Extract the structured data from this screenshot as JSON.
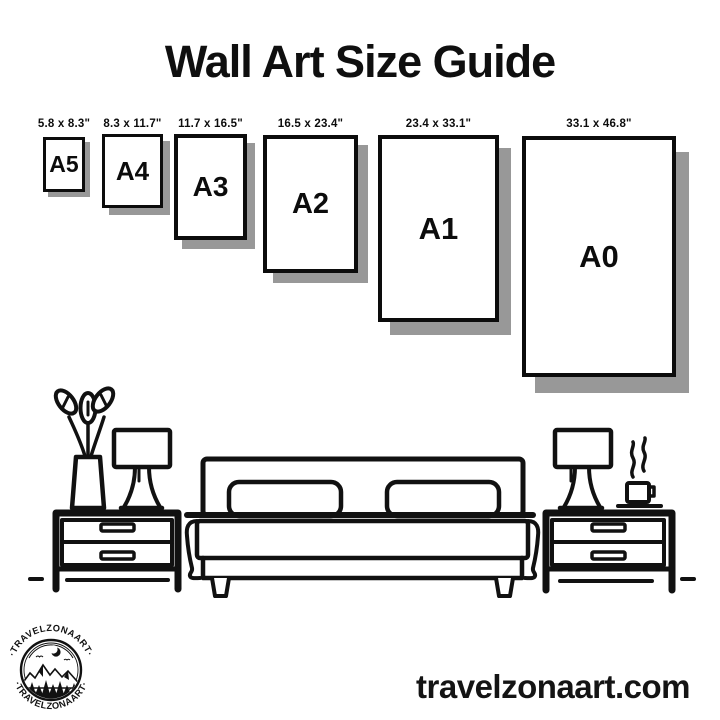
{
  "title": "Wall Art Size Guide",
  "website": "travelzonaart.com",
  "colors": {
    "ink": "#111111",
    "shadow": "#989898",
    "paper": "#ffffff"
  },
  "sizes": [
    {
      "label": "A5",
      "dimensions": "5.8 x 8.3\""
    },
    {
      "label": "A4",
      "dimensions": "8.3 x 11.7\""
    },
    {
      "label": "A3",
      "dimensions": "11.7 x 16.5\""
    },
    {
      "label": "A2",
      "dimensions": "16.5 x 23.4\""
    },
    {
      "label": "A1",
      "dimensions": "23.4 x 33.1\""
    },
    {
      "label": "A0",
      "dimensions": "33.1 x 46.8\""
    }
  ],
  "logo": {
    "top_text": "·TRAVELZONAART·",
    "bottom_text": "·TRAVELZONAART·"
  },
  "scene_icons": [
    "flower-vase-icon",
    "table-lamp-icon",
    "nightstand-icon",
    "bed-icon",
    "coffee-cup-icon"
  ]
}
